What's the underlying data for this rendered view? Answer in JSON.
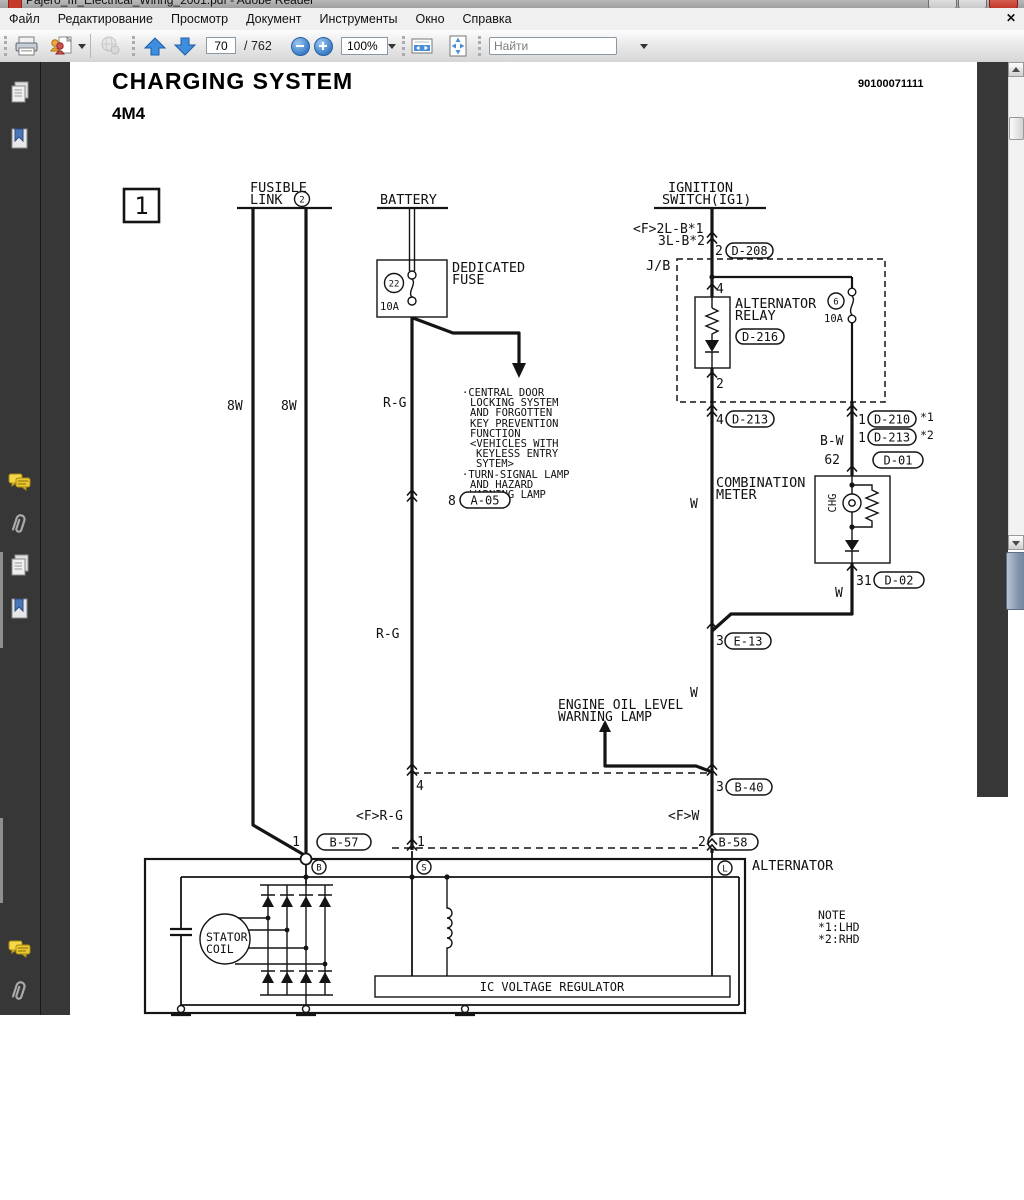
{
  "window": {
    "title": "Pajero_III_Electrical_Wiring_2001.pdf - Adobe Reader",
    "close_glyph": "✕"
  },
  "menu": {
    "items": [
      "Файл",
      "Редактирование",
      "Просмотр",
      "Документ",
      "Инструменты",
      "Окно",
      "Справка"
    ]
  },
  "toolbar": {
    "page_current": "70",
    "page_total": "/ 762",
    "zoom_level": "100%",
    "find_placeholder": "Найти"
  },
  "page": {
    "title": "CHARGING SYSTEM",
    "subtitle": "4M4",
    "doc_number": "90100071111"
  },
  "diagram": {
    "frame_number": "1",
    "labels": {
      "fusible1": "FUSIBLE",
      "fusible2": "LINK",
      "fusible_circ": "2",
      "battery": "BATTERY",
      "ign1": "IGNITION",
      "ign2": "SWITCH(IG1)",
      "wire_f2lb": "<F>2L-B*1",
      "wire_3lb": "3L-B*2",
      "pin_d208": "2",
      "d208": "D-208",
      "jb": "J/B",
      "pin_relay_in": "4",
      "relay1": "ALTERNATOR",
      "relay2": "RELAY",
      "relay_circ": "6",
      "relay_amp": "10A",
      "d216": "D-216",
      "pin_relay_out": "2",
      "ded1": "DEDICATED",
      "ded2": "FUSE",
      "fuse_circ": "22",
      "fuse_amp": "10A",
      "wire_rg_1": "R-G",
      "wire_rg_2": "R-G",
      "wire_8w_1": "8W",
      "wire_8w_2": "8W",
      "pin_a05": "8",
      "a05": "A-05",
      "pin_d213a": "4",
      "d213a": "D-213",
      "pin_d210": "1",
      "d210": "D-210",
      "d210_ref": "*1",
      "pin_d213b": "1",
      "d213b": "D-213",
      "d213b_ref": "*2",
      "wire_bw": "B-W",
      "pin_d01": "62",
      "d01": "D-01",
      "comb1": "COMBINATION",
      "comb2": "METER",
      "ch g": "CHG",
      "chg": "CHG",
      "pin_d02": "31",
      "d02": "D-02",
      "wire_w_1": "W",
      "wire_w_2": "W",
      "wire_w_3": "W",
      "pin_e13": "3",
      "e13": "E-13",
      "oil1": "ENGINE OIL LEVEL",
      "oil2": "WARNING LAMP",
      "pin_b40": "3",
      "b40": "B-40",
      "pin_4": "4",
      "pin_1a": "1",
      "wire_frg": "<F>R-G",
      "wire_fw": "<F>W",
      "pin_b57": "1",
      "b57": "B-57",
      "pin_b58": "2",
      "b58": "B-58",
      "term_b": "B",
      "term_s": "S",
      "term_l": "L",
      "alternator": "ALTERNATOR",
      "note_title": "NOTE",
      "note_1": "*1:LHD",
      "note_2": "*2:RHD",
      "stator1": "STATOR",
      "stator2": "COIL",
      "regulator": "IC VOLTAGE REGULATOR"
    },
    "note_lines": [
      "·CENTRAL DOOR",
      "LOCKING SYSTEM",
      "AND FORGOTTEN",
      "KEY PREVENTION",
      "FUNCTION",
      "<VEHICLES WITH",
      "KEYLESS ENTRY",
      "SYTEM>",
      "·TURN-SIGNAL LAMP",
      "AND HAZARD",
      "WARNING LAMP"
    ]
  }
}
